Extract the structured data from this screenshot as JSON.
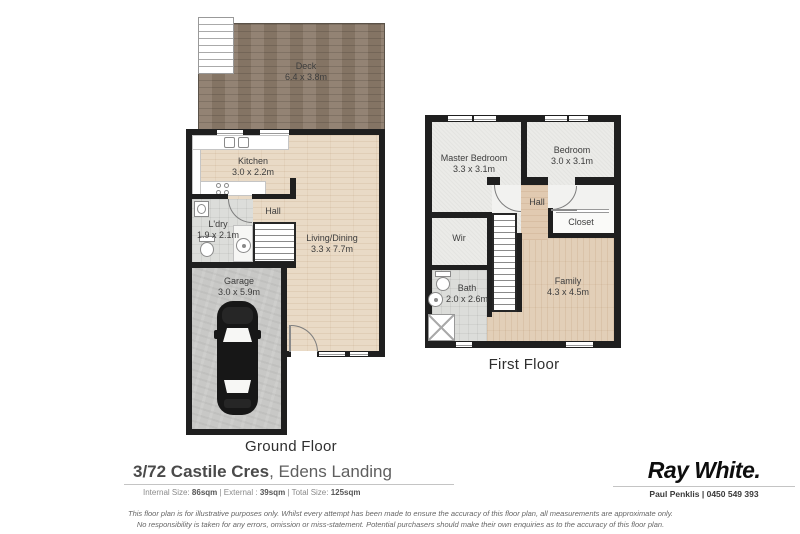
{
  "ground_floor": {
    "title": "Ground Floor",
    "rooms": {
      "deck": {
        "name": "Deck",
        "dims": "6.4 x 3.8m"
      },
      "kitchen": {
        "name": "Kitchen",
        "dims": "3.0 x 2.2m"
      },
      "hall": {
        "name": "Hall"
      },
      "ldry": {
        "name": "L'dry",
        "dims": "1.9 x 2.1m"
      },
      "living": {
        "name": "Living/Dining",
        "dims": "3.3 x 7.7m"
      },
      "garage": {
        "name": "Garage",
        "dims": "3.0 x 5.9m"
      }
    }
  },
  "first_floor": {
    "title": "First Floor",
    "rooms": {
      "master": {
        "name": "Master Bedroom",
        "dims": "3.3 x 3.1m"
      },
      "bedroom": {
        "name": "Bedroom",
        "dims": "3.0 x 3.1m"
      },
      "hall": {
        "name": "Hall"
      },
      "closet": {
        "name": "Closet"
      },
      "wir": {
        "name": "Wir"
      },
      "bath": {
        "name": "Bath",
        "dims": "2.0 x 2.6m"
      },
      "family": {
        "name": "Family",
        "dims": "4.3 x 4.5m"
      }
    }
  },
  "footer": {
    "address_primary": "3/72 Castile Cres",
    "address_secondary": ", Edens Landing",
    "size_parts": [
      {
        "t": "Internal Size: "
      },
      {
        "t": "86sqm",
        "b": true
      },
      {
        "t": " | External : "
      },
      {
        "t": "39sqm",
        "b": true
      },
      {
        "t": " | Total Size: "
      },
      {
        "t": "125sqm",
        "b": true
      }
    ]
  },
  "agency": {
    "brand": "Ray White.",
    "agent": "Paul Penklis | 0450 549 393"
  },
  "disclaimer": {
    "line1": "This floor plan is for illustrative purposes only. Whilst every attempt has been made to ensure the accuracy of this floor plan, all measurements are approximate only.",
    "line2": "No responsibility is taken for any errors, omission or miss-statement. Potential purchasers should make their own enquiries as to the accuracy of this floor plan."
  },
  "colors": {
    "wall": "#1f1f1f",
    "wood_light": "#e9dac6",
    "wood_family": "#e2cfb8",
    "hall_tan": "#e1cab1",
    "deck": "#8b7a69",
    "carpet": "#ebebe8",
    "tile": "#dcddda",
    "concrete": "#c8c8c6",
    "label_text": "#3d3d3d"
  }
}
